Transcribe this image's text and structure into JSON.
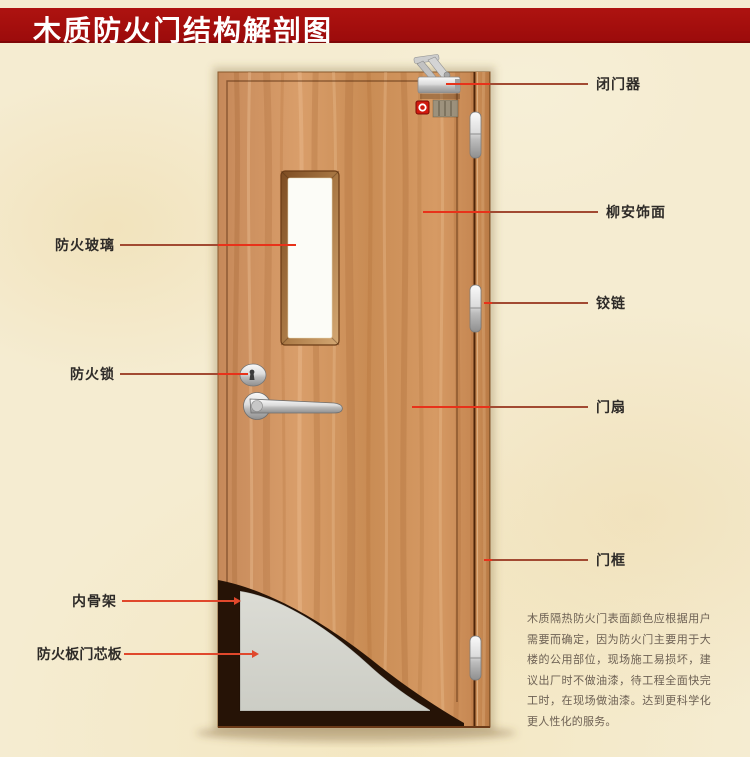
{
  "title": {
    "text": "木质防火门结构解剖图"
  },
  "labels": {
    "left": [
      {
        "id": "fire-glass",
        "text": "防火玻璃"
      },
      {
        "id": "fire-lock",
        "text": "防火锁"
      },
      {
        "id": "inner-skeleton",
        "text": "内骨架"
      },
      {
        "id": "fire-board-core",
        "text": "防火板门芯板"
      }
    ],
    "right": [
      {
        "id": "door-closer",
        "text": "闭门器"
      },
      {
        "id": "lauan-veneer",
        "text": "柳安饰面"
      },
      {
        "id": "hinge",
        "text": "铰链"
      },
      {
        "id": "door-leaf",
        "text": "门扇"
      },
      {
        "id": "door-frame",
        "text": "门框"
      }
    ]
  },
  "description": {
    "text": "木质隔热防火门表面颜色应根据用户需要而确定，因为防火门主要用于大楼的公用部位，现场施工易损坏，建议出厂时不做油漆，待工程全面快完工时，在现场做油漆。达到更科学化更人性化的服务。"
  },
  "colors": {
    "title_bar": "#a30d0d",
    "background": "#f5ecd1",
    "leader_muted": "#a24a32",
    "leader_bright": "#e8321a",
    "leader_orange": "#e0482c",
    "wood_light": "#d79a66",
    "wood_dark": "#b97c46",
    "core_gray": "#d7d7d0",
    "skeleton_dark": "#261306"
  }
}
